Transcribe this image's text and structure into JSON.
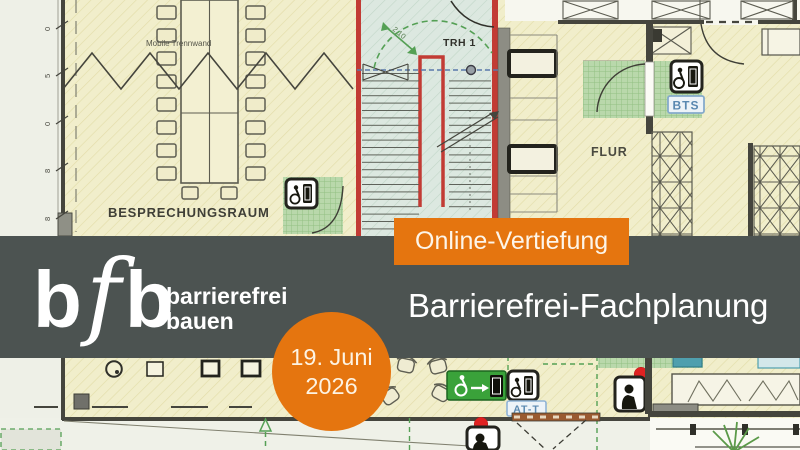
{
  "banner": {
    "badge": "Online-Vertiefung",
    "title": "Barrierefrei-Fachplanung",
    "date_line1": "19. Juni",
    "date_line2": "2026"
  },
  "logo": {
    "b1": "b",
    "f": "f",
    "b2": "b",
    "tagline1": "barrierefrei",
    "tagline2": "bauen"
  },
  "floorplan": {
    "labels": {
      "meeting_room": "BESPRECHUNGSRAUM",
      "partition": "Mobile Trennwand",
      "stairwell": "TRH 1",
      "corridor": "FLUR",
      "sign_bts": "BTS",
      "sign_att": "AT-T",
      "stair_dimension": "2,10"
    },
    "dimension_ticks": [
      "0",
      "5",
      "0",
      "8",
      "8"
    ],
    "icons": [
      "wheelchair-door-icon",
      "accessible-exit-icon",
      "person-door-sign-icon",
      "plant-icon"
    ]
  },
  "colors": {
    "accent_orange": "#e5750f",
    "band_gray": "#4c5351",
    "plan_cream": "#f1eecb",
    "stair_tint": "#dce8e0",
    "zone_green": "#b9d8ab",
    "wall_red": "#c23b34",
    "exit_green": "#3aa23a",
    "signal_red": "#e02222",
    "label_blue": "#5a88b0"
  }
}
